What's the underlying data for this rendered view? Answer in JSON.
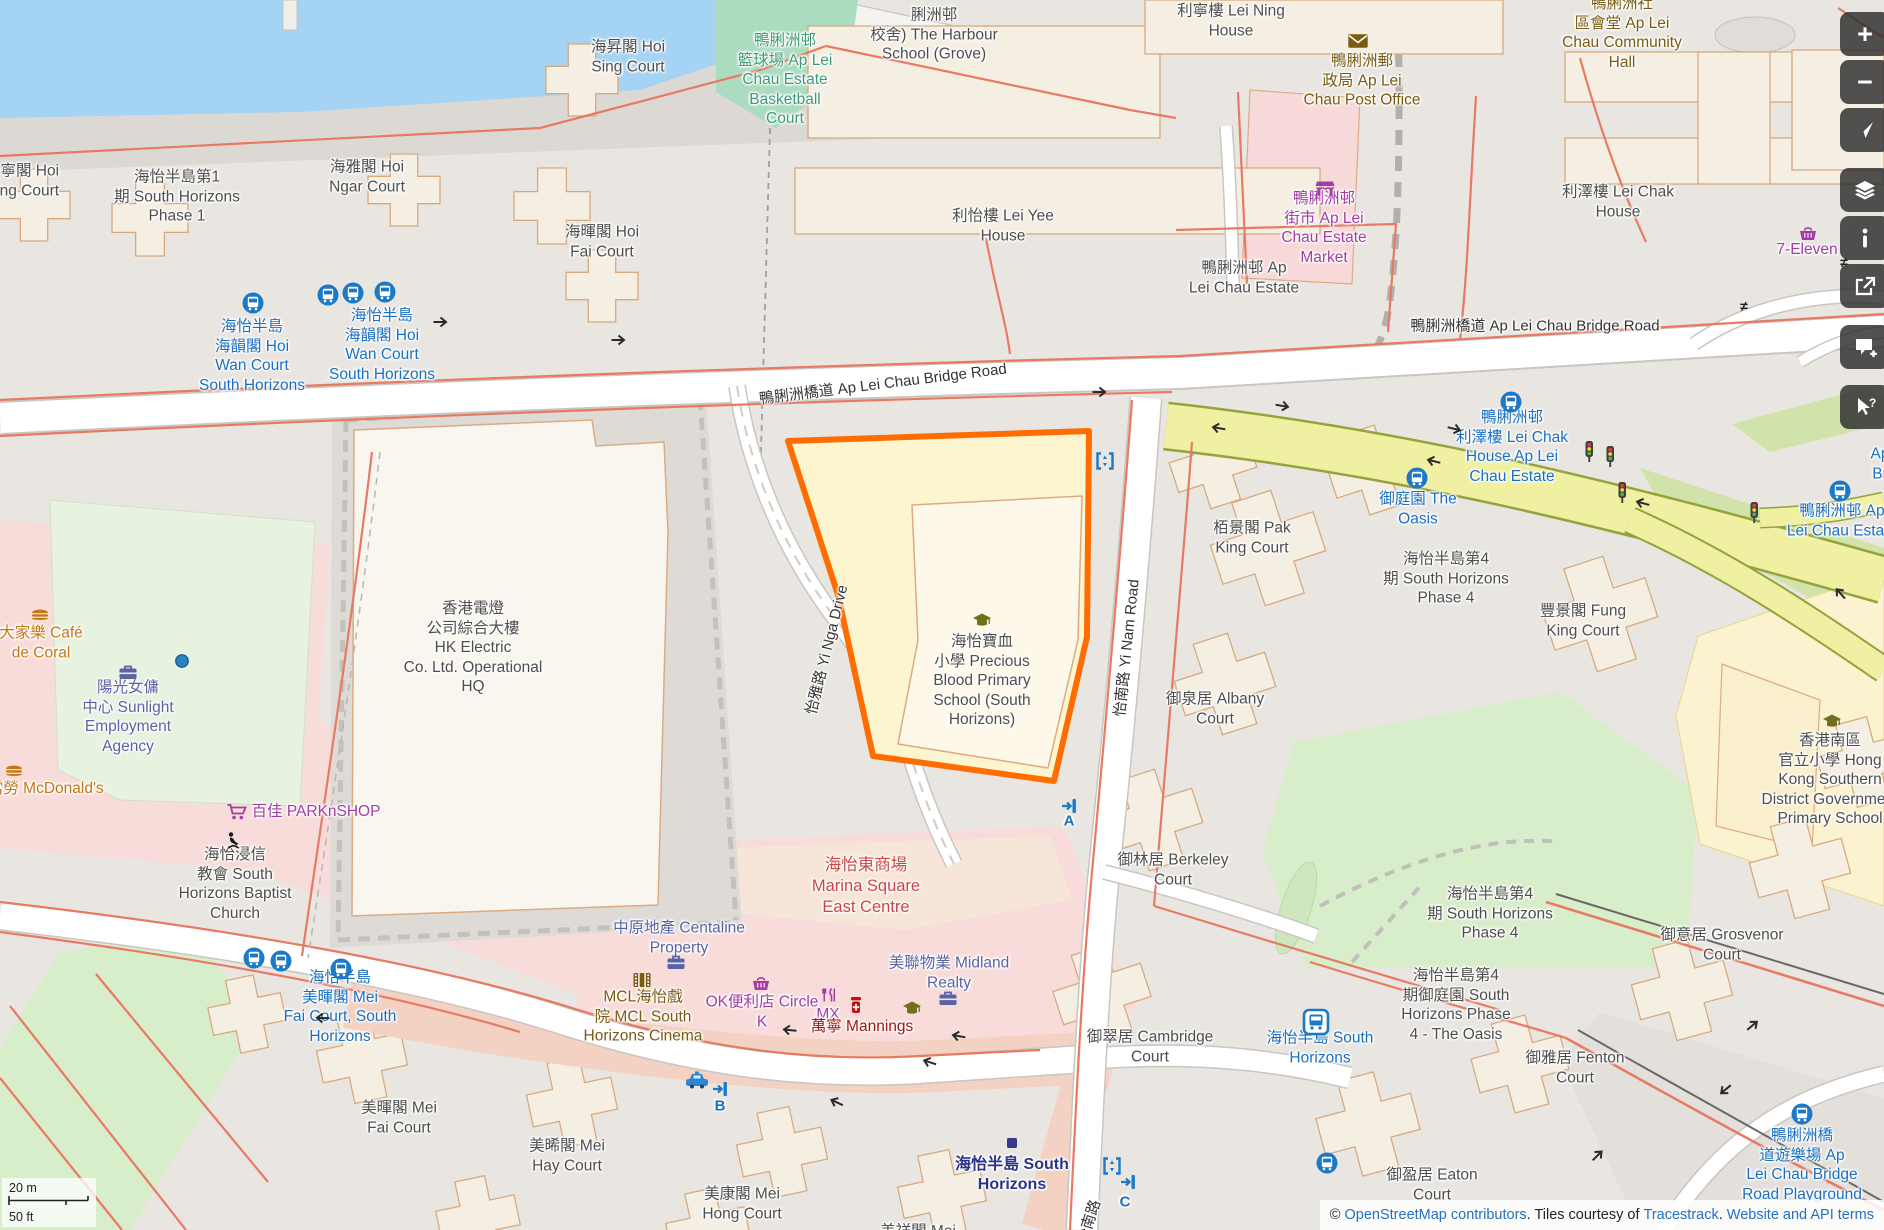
{
  "map": {
    "labels": [
      {
        "name": "label-hoi-ning-court",
        "text": "海寧閣 Hoi\nNing Court",
        "x": 22,
        "y": 181,
        "cls": "name"
      },
      {
        "name": "label-south-horizons-phase1",
        "text": "海怡半島第1\n期 South Horizons\nPhase 1",
        "x": 177,
        "y": 197,
        "cls": "name"
      },
      {
        "name": "label-hoi-ngar-court",
        "text": "海雅閣 Hoi\nNgar Court",
        "x": 367,
        "y": 177,
        "cls": "name"
      },
      {
        "name": "label-hoi-sing-court",
        "text": "海昇閣 Hoi\nSing Court",
        "x": 628,
        "y": 57,
        "cls": "name"
      },
      {
        "name": "label-hoi-fai-court",
        "text": "海暉閣 Hoi\nFai Court",
        "x": 602,
        "y": 242,
        "cls": "name"
      },
      {
        "name": "label-harbour-school",
        "text": "脷洲邨\n校舍) The Harbour\nSchool (Grove)",
        "x": 934,
        "y": 35,
        "cls": "name"
      },
      {
        "name": "label-basketball-court",
        "text": "鴨脷洲邨\n籃球場 Ap Lei\nChau Estate\nBasketball\nCourt",
        "x": 785,
        "y": 80,
        "cls": "leisure"
      },
      {
        "name": "label-lei-ning-house",
        "text": "利寧樓 Lei Ning\nHouse",
        "x": 1231,
        "y": 21,
        "cls": "name"
      },
      {
        "name": "label-community-hall",
        "text": "鴨脷洲社\n區會堂 Ap Lei\nChau Community\nHall",
        "x": 1622,
        "y": 33,
        "cls": "amenity"
      },
      {
        "name": "label-post-office",
        "text": "鴨脷洲郵\n政局 Ap Lei\nChau Post Office",
        "x": 1362,
        "y": 81,
        "cls": "amenity"
      },
      {
        "name": "label-estate-market",
        "text": "鴨脷洲邨\n街市 Ap Lei\nChau Estate\nMarket",
        "x": 1324,
        "y": 228,
        "cls": "shop"
      },
      {
        "name": "label-lei-yee-house",
        "text": "利怡樓 Lei Yee\nHouse",
        "x": 1003,
        "y": 226,
        "cls": "name"
      },
      {
        "name": "label-lei-chak-house",
        "text": "利澤樓 Lei Chak\nHouse",
        "x": 1618,
        "y": 202,
        "cls": "name"
      },
      {
        "name": "label-seven-eleven",
        "text": "7-Eleven",
        "x": 1807,
        "y": 250,
        "cls": "shop"
      },
      {
        "name": "label-ap-lei-chau-estate",
        "text": "鴨脷洲邨 Ap\nLei Chau Estate",
        "x": 1244,
        "y": 278,
        "cls": "name"
      },
      {
        "name": "label-bridge-road-right",
        "text": "鴨脷洲橋道 Ap Lei Chau Bridge Road",
        "x": 1535,
        "y": 327,
        "cls": "road"
      },
      {
        "name": "label-bridge-road-center",
        "text": "鴨脷洲橋道 Ap Lei Chau Bridge Road",
        "x": 883,
        "y": 385,
        "cls": "road",
        "rot": -7
      },
      {
        "name": "label-hoi-wan-stop-1",
        "text": "海怡半島\n海韻閣 Hoi\nWan Court\nSouth Horizons",
        "x": 252,
        "y": 356,
        "cls": "transit"
      },
      {
        "name": "label-hoi-wan-stop-2",
        "text": "海怡半島\n海韻閣 Hoi\nWan Court\nSouth Horizons",
        "x": 382,
        "y": 345,
        "cls": "transit"
      },
      {
        "name": "label-hk-electric",
        "text": "香港電燈\n公司綜合大樓\nHK Electric\nCo. Ltd. Operational\nHQ",
        "x": 473,
        "y": 648,
        "cls": "name"
      },
      {
        "name": "label-yi-nga-drive",
        "text": "怡雅路 Yi Nga Drive",
        "x": 828,
        "y": 650,
        "cls": "road",
        "rot": -76
      },
      {
        "name": "label-precious-blood-school",
        "text": "海怡寶血\n小學 Precious\nBlood Primary\nSchool (South\nHorizons)",
        "x": 982,
        "y": 681,
        "cls": "name"
      },
      {
        "name": "label-pak-king-court",
        "text": "栢景閣 Pak\nKing Court",
        "x": 1252,
        "y": 538,
        "cls": "name"
      },
      {
        "name": "label-phase4-upper",
        "text": "海怡半島第4\n期 South Horizons\nPhase 4",
        "x": 1446,
        "y": 579,
        "cls": "name"
      },
      {
        "name": "label-fung-king-court",
        "text": "豐景閣 Fung\nKing Court",
        "x": 1583,
        "y": 621,
        "cls": "name"
      },
      {
        "name": "label-oasis-stop",
        "text": "御庭園 The\nOasis",
        "x": 1418,
        "y": 509,
        "cls": "transit"
      },
      {
        "name": "label-lei-chak-stop",
        "text": "鴨脷洲邨\n利澤樓 Lei Chak\nHouse Ap Lei\nChau Estate",
        "x": 1512,
        "y": 447,
        "cls": "transit"
      },
      {
        "name": "label-estate-stop-right",
        "text": "鴨脷洲邨 Ap\nLei Chau Estate",
        "x": 1842,
        "y": 521,
        "cls": "transit"
      },
      {
        "name": "label-clipped-ap-br",
        "text": "Ap\nBr",
        "x": 1880,
        "y": 464,
        "cls": "transit"
      },
      {
        "name": "label-albany-court",
        "text": "御泉居 Albany\nCourt",
        "x": 1215,
        "y": 709,
        "cls": "name"
      },
      {
        "name": "label-hksd-school",
        "text": "香港南區\n官立小學 Hong\nKong Southern\nDistrict Government\nPrimary School",
        "x": 1830,
        "y": 780,
        "cls": "name"
      },
      {
        "name": "label-cafe-de-coral",
        "text": "大家樂 Café\nde Coral",
        "x": 41,
        "y": 643,
        "cls": "food"
      },
      {
        "name": "label-sunlight-agency",
        "text": "陽光女傭\n中心 Sunlight\nEmployment\nAgency",
        "x": 128,
        "y": 717,
        "cls": "office"
      },
      {
        "name": "label-mcdonalds",
        "text": "麥當勞 McDonald's",
        "x": 38,
        "y": 789,
        "cls": "food"
      },
      {
        "name": "label-parknshop",
        "text": "百佳 PARKnSHOP",
        "x": 316,
        "y": 812,
        "cls": "shop"
      },
      {
        "name": "label-baptist-church",
        "text": "海怡浸信\n教會 South\nHorizons Baptist\nChurch",
        "x": 235,
        "y": 884,
        "cls": "name"
      },
      {
        "name": "label-marina-square",
        "text": "海怡東商場\nMarina Square\nEast Centre",
        "x": 866,
        "y": 886,
        "cls": "mall"
      },
      {
        "name": "label-centaline",
        "text": "中原地產 Centaline\nProperty",
        "x": 679,
        "y": 938,
        "cls": "office"
      },
      {
        "name": "label-midland",
        "text": "美聯物業 Midland\nRealty",
        "x": 949,
        "y": 973,
        "cls": "office"
      },
      {
        "name": "label-mcl-cinema",
        "text": "MCL海怡戲\n院 MCL South\nHorizons Cinema",
        "x": 643,
        "y": 1017,
        "cls": "amenity"
      },
      {
        "name": "label-circle-k",
        "text": "OK便利店 Circle\nK",
        "x": 762,
        "y": 1012,
        "cls": "shop"
      },
      {
        "name": "label-mx",
        "text": "MX",
        "x": 828,
        "y": 1015,
        "cls": "shop"
      },
      {
        "name": "label-mannings",
        "text": "萬寧 Mannings",
        "x": 862,
        "y": 1027,
        "cls": "health"
      },
      {
        "name": "label-berkeley-court",
        "text": "御林居 Berkeley\nCourt",
        "x": 1173,
        "y": 870,
        "cls": "name"
      },
      {
        "name": "label-cambridge-court",
        "text": "御翠居 Cambridge\nCourt",
        "x": 1150,
        "y": 1047,
        "cls": "name"
      },
      {
        "name": "label-sh-bus-station",
        "text": "海怡半島 South\nHorizons",
        "x": 1320,
        "y": 1048,
        "cls": "transit"
      },
      {
        "name": "label-phase4-lower",
        "text": "海怡半島第4\n期 South Horizons\nPhase 4",
        "x": 1490,
        "y": 914,
        "cls": "name"
      },
      {
        "name": "label-oasis-phase4",
        "text": "海怡半島第4\n期御庭園 South\nHorizons Phase\n4 - The Oasis",
        "x": 1456,
        "y": 1005,
        "cls": "name"
      },
      {
        "name": "label-fenton-court",
        "text": "御雅居 Fenton\nCourt",
        "x": 1575,
        "y": 1068,
        "cls": "name"
      },
      {
        "name": "label-grosvenor-court",
        "text": "御意居 Grosvenor\nCourt",
        "x": 1722,
        "y": 945,
        "cls": "name"
      },
      {
        "name": "label-eaton-court",
        "text": "御盈居 Eaton\nCourt",
        "x": 1432,
        "y": 1185,
        "cls": "name"
      },
      {
        "name": "label-bridge-playground",
        "text": "鴨脷洲橋\n道遊樂場 Ap\nLei Chau Bridge\nRoad Playground",
        "x": 1802,
        "y": 1165,
        "cls": "transit"
      },
      {
        "name": "label-mei-fai-stop",
        "text": "海怡半島\n美暉閣 Mei\nFai Court, South\nHorizons",
        "x": 340,
        "y": 1007,
        "cls": "transit"
      },
      {
        "name": "label-mei-fai-court",
        "text": "美暉閣 Mei\nFai Court",
        "x": 399,
        "y": 1118,
        "cls": "name"
      },
      {
        "name": "label-mei-hay-court",
        "text": "美晞閣 Mei\nHay Court",
        "x": 567,
        "y": 1156,
        "cls": "name"
      },
      {
        "name": "label-mei-hong-court",
        "text": "美康閣 Mei\nHong Court",
        "x": 742,
        "y": 1204,
        "cls": "name"
      },
      {
        "name": "label-mei-cheung-court",
        "text": "美祥閣 Mei",
        "x": 918,
        "y": 1232,
        "cls": "name"
      },
      {
        "name": "label-sh-station",
        "text": "海怡半島 South\nHorizons",
        "x": 1012,
        "y": 1175,
        "cls": "station"
      },
      {
        "name": "label-yi-nam-road",
        "text": "怡南路 Yi Nam Road",
        "x": 1128,
        "y": 648,
        "cls": "road",
        "rot": -84
      },
      {
        "name": "label-yi-nam-road-2",
        "text": "怡南路",
        "x": 1090,
        "y": 1222,
        "cls": "road",
        "rot": -72
      },
      {
        "name": "label-entrance-a",
        "text": "A",
        "x": 1069,
        "y": 822,
        "cls": "letter"
      },
      {
        "name": "label-entrance-b",
        "text": "B",
        "x": 720,
        "y": 1107,
        "cls": "letter"
      },
      {
        "name": "label-entrance-c",
        "text": "C",
        "x": 1125,
        "y": 1203,
        "cls": "letter"
      }
    ],
    "markers": [
      {
        "name": "bus-stop-icon",
        "type": "bus_stop",
        "x": 253,
        "y": 303
      },
      {
        "name": "bus-stop-icon",
        "type": "bus_stop",
        "x": 328,
        "y": 295
      },
      {
        "name": "bus-stop-icon",
        "type": "bus_stop",
        "x": 353,
        "y": 293
      },
      {
        "name": "bus-stop-icon",
        "type": "bus_stop",
        "x": 385,
        "y": 292
      },
      {
        "name": "bus-stop-icon",
        "type": "bus_stop",
        "x": 254,
        "y": 958
      },
      {
        "name": "bus-stop-icon",
        "type": "bus_stop",
        "x": 281,
        "y": 961
      },
      {
        "name": "bus-stop-icon",
        "type": "bus_stop",
        "x": 341,
        "y": 969
      },
      {
        "name": "bus-stop-icon",
        "type": "bus_stop",
        "x": 1417,
        "y": 478
      },
      {
        "name": "bus-stop-icon",
        "type": "bus_stop",
        "x": 1511,
        "y": 402
      },
      {
        "name": "bus-stop-icon",
        "type": "bus_stop",
        "x": 1840,
        "y": 491
      },
      {
        "name": "bus-stop-icon",
        "type": "bus_stop",
        "x": 1327,
        "y": 1163
      },
      {
        "name": "bus-stop-icon",
        "type": "bus_stop",
        "x": 1802,
        "y": 1114
      },
      {
        "name": "bus-station-icon",
        "type": "bus_station",
        "x": 1316,
        "y": 1022
      },
      {
        "name": "taxi-stand-icon",
        "type": "taxi",
        "x": 697,
        "y": 1080
      },
      {
        "name": "subway-entrance-icon",
        "type": "entrance",
        "x": 1069,
        "y": 806
      },
      {
        "name": "subway-entrance-icon",
        "type": "entrance",
        "x": 720,
        "y": 1089
      },
      {
        "name": "subway-entrance-icon",
        "type": "entrance",
        "x": 1128,
        "y": 1182
      },
      {
        "name": "elevator-icon",
        "type": "lift",
        "x": 1105,
        "y": 461
      },
      {
        "name": "elevator-icon",
        "type": "lift",
        "x": 1112,
        "y": 1166
      },
      {
        "name": "poi-dot",
        "type": "dot",
        "x": 182,
        "y": 661
      },
      {
        "name": "traffic-signal-icon",
        "type": "traffic_light",
        "x": 1589,
        "y": 452
      },
      {
        "name": "traffic-signal-icon",
        "type": "traffic_light",
        "x": 1610,
        "y": 457
      },
      {
        "name": "traffic-signal-icon",
        "type": "traffic_light",
        "x": 1622,
        "y": 493
      },
      {
        "name": "traffic-signal-icon",
        "type": "traffic_light",
        "x": 1754,
        "y": 513
      },
      {
        "name": "station-marker",
        "type": "mtr_square",
        "x": 1012,
        "y": 1143
      },
      {
        "name": "post-office-icon",
        "type": "envelope",
        "x": 1358,
        "y": 41
      },
      {
        "name": "marketplace-icon",
        "type": "market_stall",
        "x": 1325,
        "y": 189
      },
      {
        "name": "convenience-store-icon",
        "type": "basket",
        "x": 761,
        "y": 983
      },
      {
        "name": "convenience-store-icon",
        "type": "basket",
        "x": 1808,
        "y": 233
      },
      {
        "name": "supermarket-icon",
        "type": "cart",
        "x": 237,
        "y": 812
      },
      {
        "name": "fast-food-icon",
        "type": "burger",
        "x": 40,
        "y": 614
      },
      {
        "name": "fast-food-icon",
        "type": "burger",
        "x": 14,
        "y": 770
      },
      {
        "name": "office-icon",
        "type": "briefcase",
        "x": 128,
        "y": 672
      },
      {
        "name": "office-icon",
        "type": "briefcase",
        "x": 676,
        "y": 962
      },
      {
        "name": "office-icon",
        "type": "briefcase",
        "x": 948,
        "y": 998
      },
      {
        "name": "cinema-icon",
        "type": "film",
        "x": 642,
        "y": 980
      },
      {
        "name": "pharmacy-icon",
        "type": "pills",
        "x": 856,
        "y": 1005
      },
      {
        "name": "restaurant-icon",
        "type": "mx_icon",
        "x": 829,
        "y": 995
      },
      {
        "name": "school-icon",
        "type": "school",
        "x": 982,
        "y": 620
      },
      {
        "name": "school-icon",
        "type": "school",
        "x": 1832,
        "y": 721
      },
      {
        "name": "school-icon",
        "type": "school",
        "x": 912,
        "y": 1008
      },
      {
        "name": "place-of-worship-icon",
        "type": "praying",
        "x": 233,
        "y": 840
      },
      {
        "name": "one-way-arrow-icon",
        "type": "arrow",
        "x": 441,
        "y": 322,
        "rot": 0
      },
      {
        "name": "one-way-arrow-icon",
        "type": "arrow",
        "x": 619,
        "y": 340,
        "rot": 0
      },
      {
        "name": "one-way-arrow-icon",
        "type": "arrow",
        "x": 1100,
        "y": 392,
        "rot": 0
      },
      {
        "name": "one-way-arrow-icon",
        "type": "arrow",
        "x": 1283,
        "y": 406,
        "rot": 10
      },
      {
        "name": "one-way-arrow-icon",
        "type": "arrow",
        "x": 1455,
        "y": 429,
        "rot": 14
      },
      {
        "name": "one-way-arrow-icon",
        "type": "arrow",
        "x": 1218,
        "y": 428,
        "rot": 190
      },
      {
        "name": "one-way-arrow-icon",
        "type": "arrow",
        "x": 1433,
        "y": 461,
        "rot": 194
      },
      {
        "name": "one-way-arrow-icon",
        "type": "arrow",
        "x": 1642,
        "y": 503,
        "rot": 195
      },
      {
        "name": "one-way-arrow-icon",
        "type": "arrow",
        "x": 1840,
        "y": 593,
        "rot": -132
      },
      {
        "name": "one-way-arrow-icon",
        "type": "arrow",
        "x": 322,
        "y": 1018,
        "rot": 182
      },
      {
        "name": "one-way-arrow-icon",
        "type": "arrow",
        "x": 789,
        "y": 1030,
        "rot": 186
      },
      {
        "name": "one-way-arrow-icon",
        "type": "arrow",
        "x": 958,
        "y": 1036,
        "rot": 190
      },
      {
        "name": "one-way-arrow-icon",
        "type": "arrow",
        "x": 929,
        "y": 1062,
        "rot": 198
      },
      {
        "name": "one-way-arrow-icon",
        "type": "arrow",
        "x": 836,
        "y": 1102,
        "rot": 205
      },
      {
        "name": "one-way-arrow-icon",
        "type": "arrow",
        "x": 1753,
        "y": 1025,
        "rot": -40
      },
      {
        "name": "one-way-arrow-icon",
        "type": "arrow",
        "x": 1725,
        "y": 1090,
        "rot": 140
      },
      {
        "name": "one-way-arrow-icon",
        "type": "arrow",
        "x": 1598,
        "y": 1155,
        "rot": -45
      },
      {
        "name": "no-entry-icon",
        "type": "neq",
        "x": 1844,
        "y": 262
      },
      {
        "name": "no-entry-icon",
        "type": "neq",
        "x": 1744,
        "y": 306
      }
    ],
    "controls": [
      {
        "name": "zoom-in-button",
        "icon": "plus",
        "group": 0
      },
      {
        "name": "zoom-out-button",
        "icon": "minus",
        "group": 0
      },
      {
        "name": "locate-button",
        "icon": "locate",
        "group": 0
      },
      {
        "name": "layers-button",
        "icon": "layers",
        "group": 1
      },
      {
        "name": "info-button",
        "icon": "info",
        "group": 1
      },
      {
        "name": "share-button",
        "icon": "share",
        "group": 1
      },
      {
        "name": "add-note-button",
        "icon": "comment",
        "group": 2
      },
      {
        "name": "query-features-button",
        "icon": "query",
        "group": 3
      }
    ],
    "scalebar": {
      "metric": "20 m",
      "imperial": "50 ft"
    },
    "attribution": {
      "parts": [
        {
          "text": "© ",
          "link": false
        },
        {
          "text": "OpenStreetMap contributors",
          "link": true
        },
        {
          "text": ". Tiles courtesy of ",
          "link": false
        },
        {
          "text": "Tracestrack",
          "link": true
        },
        {
          "text": ". ",
          "link": false
        },
        {
          "text": "Website and API terms",
          "link": true
        }
      ]
    },
    "colors": {
      "selection": "#ff6d00",
      "water": "#a5d3f3",
      "transit_blue": "#1b79c7",
      "yellow_road": "#eff0a2",
      "shop_purple": "#a33ca3",
      "amenity_brown": "#7a5b12"
    }
  }
}
